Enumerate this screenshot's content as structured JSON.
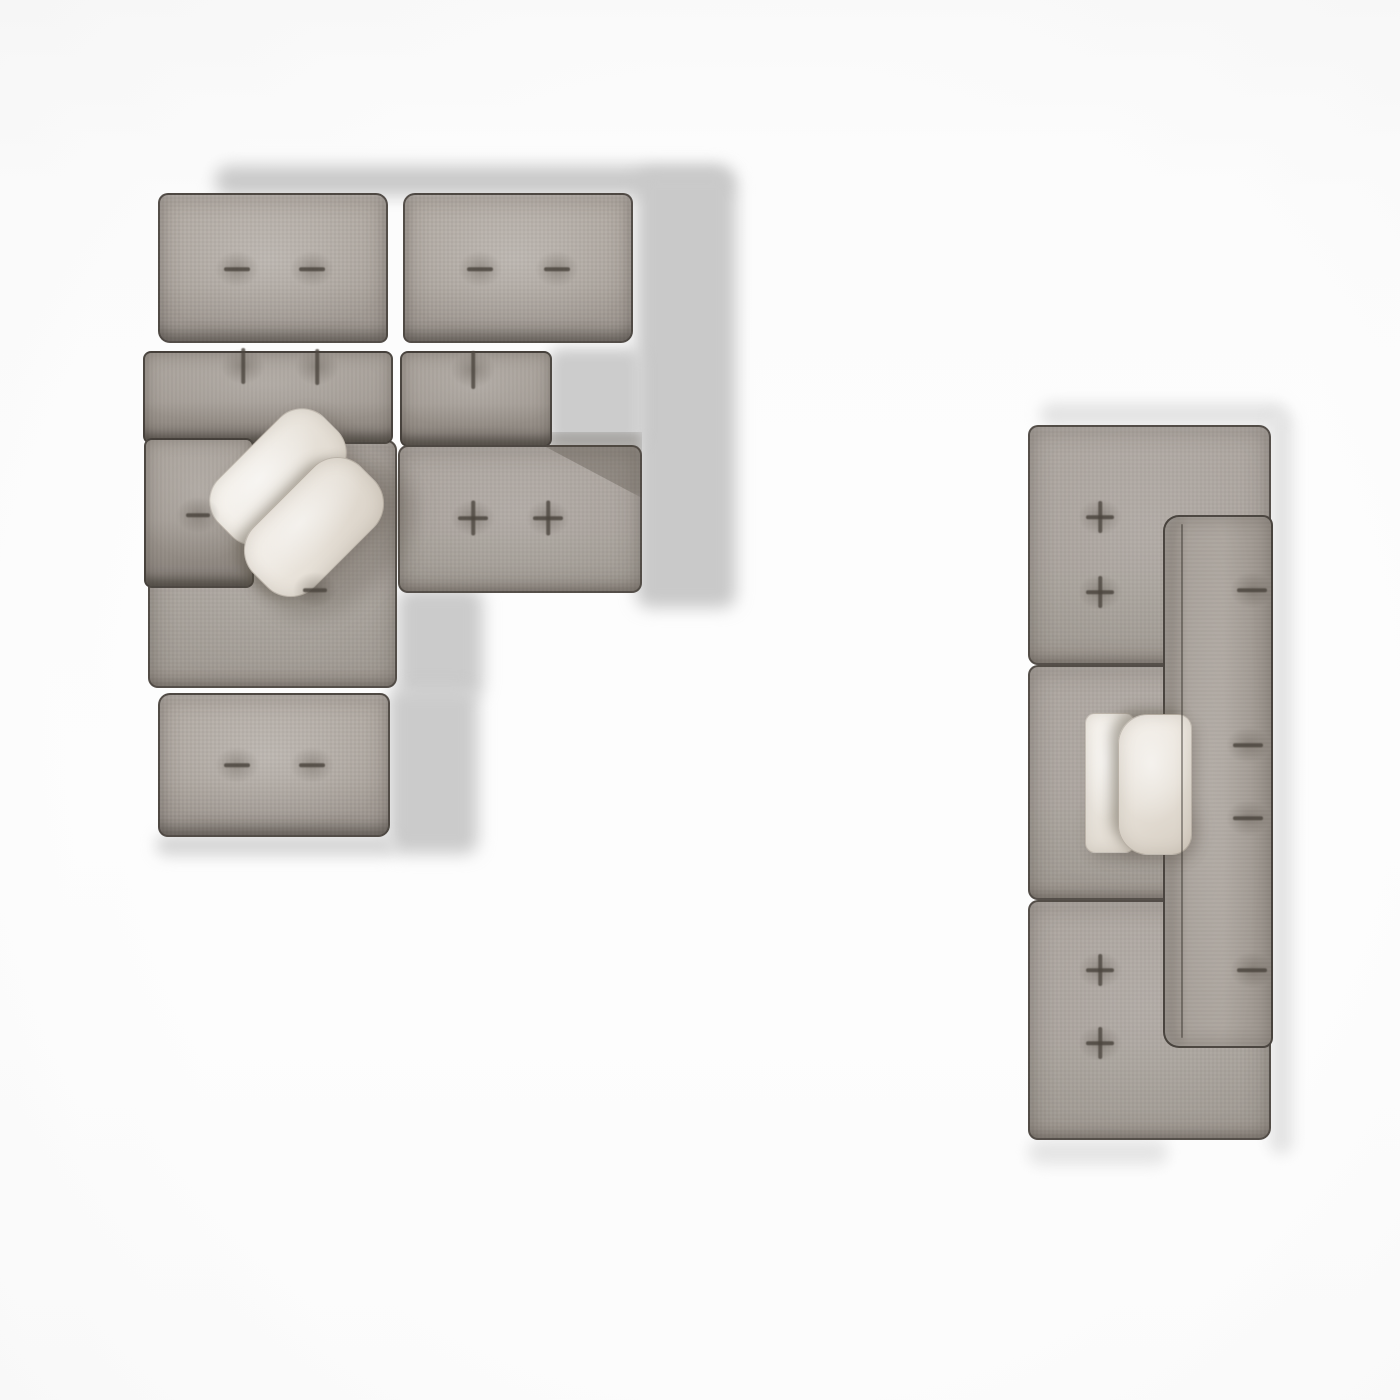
{
  "meta": {
    "view": "top-down furniture plan render",
    "canvas": {
      "width": 1400,
      "height": 1400
    }
  },
  "palette": {
    "floor": "#fafafa",
    "floor_vignette": "#f3f3f3",
    "fabric_base": "#aaa39c",
    "fabric_light": "#b2aba4",
    "fabric_dark": "#8f8881",
    "edge": "#38332e",
    "tuft_mark": "#4c463f",
    "pillow_light": "#f4f0ea",
    "pillow_dark": "#ded7cd",
    "cast_shadow_left_sofa": "#c9c9c9",
    "cast_shadow_right_sofa": "#e3e3e3"
  },
  "scene": {
    "groups": [
      {
        "name": "sectional-sofa-left",
        "shadows": [
          {
            "name": "floor-shadow-top-band",
            "x": 215,
            "y": 166,
            "w": 515,
            "h": 30,
            "c": "#c9c9c9",
            "blur": 8
          },
          {
            "name": "floor-shadow-right-column",
            "x": 636,
            "y": 170,
            "w": 100,
            "h": 438,
            "c": "#c9c9c9",
            "blur": 8
          },
          {
            "name": "floor-shadow-gap",
            "x": 548,
            "y": 348,
            "w": 94,
            "h": 100,
            "c": "#cccccc",
            "blur": 7
          },
          {
            "name": "floor-shadow-mid",
            "x": 397,
            "y": 588,
            "w": 86,
            "h": 110,
            "c": "#cbcbcb",
            "blur": 8
          },
          {
            "name": "floor-shadow-lower",
            "x": 388,
            "y": 688,
            "w": 90,
            "h": 166,
            "c": "#cbcbcb",
            "blur": 8
          },
          {
            "name": "contact-shadow-bottom",
            "x": 156,
            "y": 834,
            "w": 240,
            "h": 22,
            "c": "#d6d6d6",
            "blur": 7
          }
        ],
        "pieces": [
          {
            "name": "back-cushion-left",
            "skin": "cushion",
            "x": 158,
            "y": 193,
            "w": 230,
            "h": 150,
            "r": "10px 12px 8px 12px"
          },
          {
            "name": "back-cushion-right",
            "skin": "cushion",
            "x": 403,
            "y": 193,
            "w": 230,
            "h": 150,
            "r": "12px 10px 12px 8px"
          },
          {
            "name": "seat-module-left",
            "skin": "seat",
            "x": 148,
            "y": 440,
            "w": 249,
            "h": 248,
            "r": "10px"
          },
          {
            "name": "seat-module-right",
            "skin": "seat",
            "x": 398,
            "y": 445,
            "w": 244,
            "h": 148,
            "r": "10px"
          },
          {
            "name": "backrest-shadow-on-seat",
            "skin": "onshadow",
            "x": 545,
            "y": 432,
            "w": 97,
            "h": 66,
            "r": "0px",
            "decor": true
          },
          {
            "name": "backrest-strip-left",
            "skin": "strip",
            "x": 143,
            "y": 351,
            "w": 250,
            "h": 93,
            "r": "8px"
          },
          {
            "name": "backrest-strip-right",
            "skin": "strip",
            "x": 400,
            "y": 351,
            "w": 152,
            "h": 96,
            "r": "8px"
          },
          {
            "name": "bottom-cushion",
            "skin": "cushion",
            "x": 158,
            "y": 693,
            "w": 232,
            "h": 144,
            "r": "12px 10px 12px 10px"
          },
          {
            "name": "side-back-cushion",
            "skin": "strip",
            "x": 144,
            "y": 438,
            "w": 110,
            "h": 150,
            "r": "8px"
          },
          {
            "name": "pillow-cast-shadow",
            "skin": "soft-shadow",
            "x": 245,
            "y": 478,
            "w": 180,
            "h": 120,
            "rot": -45,
            "c": "rgba(86,78,68,0.28)",
            "blur": 10,
            "decor": true
          },
          {
            "name": "throw-pillow-upper",
            "skin": "pillow",
            "x": 203,
            "y": 436,
            "w": 150,
            "h": 82,
            "r": "32px",
            "rot": -45
          },
          {
            "name": "throw-pillow-lower",
            "skin": "pillow2",
            "x": 238,
            "y": 484,
            "w": 152,
            "h": 86,
            "r": "34px",
            "rot": -45
          }
        ],
        "marks": [
          {
            "type": "dash-h",
            "x": 237,
            "y": 269,
            "len": 26
          },
          {
            "type": "dash-h",
            "x": 312,
            "y": 269,
            "len": 26
          },
          {
            "type": "dash-h",
            "x": 480,
            "y": 269,
            "len": 26
          },
          {
            "type": "dash-h",
            "x": 557,
            "y": 269,
            "len": 26
          },
          {
            "type": "dash-v",
            "x": 243,
            "y": 366,
            "len": 36
          },
          {
            "type": "dash-v",
            "x": 317,
            "y": 367,
            "len": 36
          },
          {
            "type": "dash-v",
            "x": 473,
            "y": 370,
            "len": 38
          },
          {
            "type": "dash-h",
            "x": 198,
            "y": 515,
            "len": 24
          },
          {
            "type": "dash-h",
            "x": 315,
            "y": 590,
            "len": 24
          },
          {
            "type": "tuft-cross",
            "x": 473,
            "y": 518,
            "len": 30
          },
          {
            "type": "tuft-cross",
            "x": 548,
            "y": 518,
            "len": 30
          },
          {
            "type": "dash-h",
            "x": 237,
            "y": 765,
            "len": 26
          },
          {
            "type": "dash-h",
            "x": 312,
            "y": 765,
            "len": 26
          }
        ],
        "seams": []
      },
      {
        "name": "modular-sofa-right",
        "shadows": [
          {
            "name": "floor-shadow-top",
            "x": 1040,
            "y": 403,
            "w": 246,
            "h": 24,
            "c": "#e3e3e3",
            "blur": 7
          },
          {
            "name": "floor-shadow-right",
            "x": 1269,
            "y": 412,
            "w": 24,
            "h": 742,
            "c": "#e3e3e3",
            "blur": 7
          },
          {
            "name": "floor-shadow-bottom",
            "x": 1028,
            "y": 1139,
            "w": 140,
            "h": 26,
            "c": "#e5e5e5",
            "blur": 7
          }
        ],
        "pieces": [
          {
            "name": "seat-module-top",
            "skin": "seat",
            "x": 1028,
            "y": 425,
            "w": 243,
            "h": 240,
            "r": "10px 12px 10px 10px"
          },
          {
            "name": "seat-module-middle",
            "skin": "seat",
            "x": 1028,
            "y": 665,
            "w": 243,
            "h": 235,
            "r": "10px"
          },
          {
            "name": "seat-module-bottom",
            "skin": "seat",
            "x": 1028,
            "y": 900,
            "w": 243,
            "h": 240,
            "r": "10px 10px 12px 10px"
          },
          {
            "name": "backrest-strip-vertical",
            "skin": "strip-v",
            "x": 1163,
            "y": 515,
            "w": 110,
            "h": 533,
            "r": "16px 10px 10px 16px"
          },
          {
            "name": "pillow-cast-shadow",
            "skin": "soft-shadow",
            "x": 1092,
            "y": 798,
            "w": 104,
            "h": 62,
            "c": "rgba(86,78,68,0.22)",
            "blur": 9,
            "decor": true
          },
          {
            "name": "throw-pillow-left-flap",
            "skin": "pillow",
            "x": 1085,
            "y": 713,
            "w": 50,
            "h": 140,
            "r": "10px"
          },
          {
            "name": "throw-pillow-right-flap",
            "skin": "pillow2",
            "x": 1118,
            "y": 714,
            "w": 74,
            "h": 141,
            "r": "30px 14px 20px 30px"
          }
        ],
        "marks": [
          {
            "type": "tuft-cross",
            "x": 1100,
            "y": 517,
            "len": 28
          },
          {
            "type": "tuft-cross",
            "x": 1100,
            "y": 592,
            "len": 28
          },
          {
            "type": "dash-h",
            "x": 1252,
            "y": 590,
            "len": 30
          },
          {
            "type": "dash-h",
            "x": 1248,
            "y": 745,
            "len": 30
          },
          {
            "type": "dash-h",
            "x": 1248,
            "y": 818,
            "len": 30
          },
          {
            "type": "tuft-cross",
            "x": 1100,
            "y": 970,
            "len": 28
          },
          {
            "type": "tuft-cross",
            "x": 1100,
            "y": 1043,
            "len": 28
          },
          {
            "type": "dash-h",
            "x": 1252,
            "y": 970,
            "len": 30
          }
        ],
        "seams": [
          {
            "name": "backrest-ridge",
            "x": 1181,
            "y": 524,
            "w": 2,
            "h": 514
          }
        ]
      }
    ]
  }
}
